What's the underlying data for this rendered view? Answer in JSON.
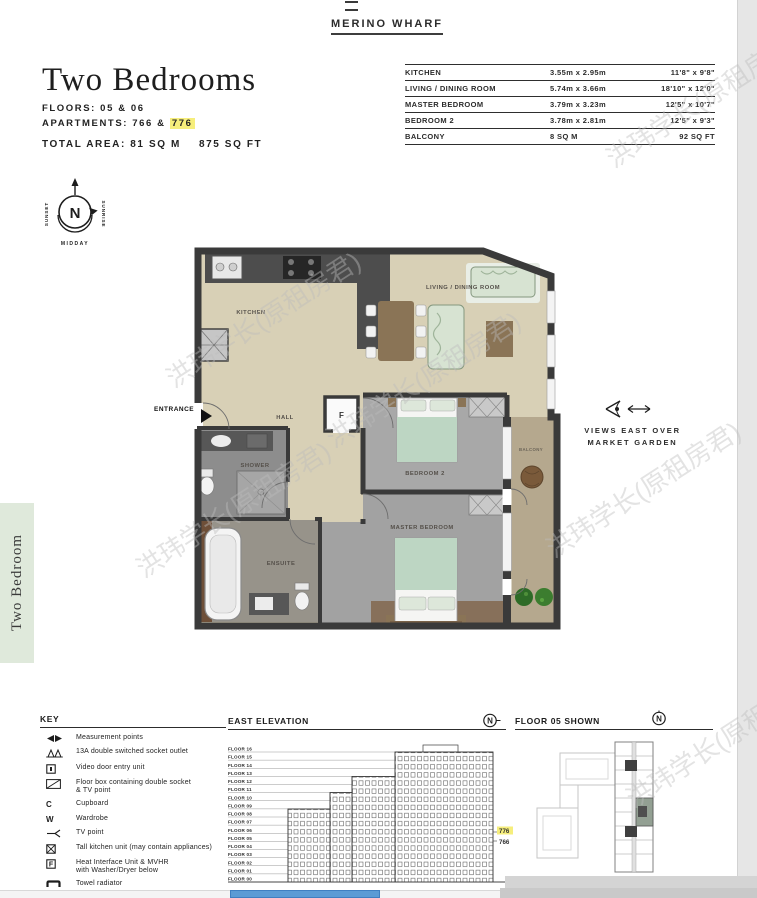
{
  "header": {
    "brand": "MERINO WHARF"
  },
  "title_block": {
    "title": "Two Bedrooms",
    "floors": "FLOORS: 05 & 06",
    "apartments_prefix": "APARTMENTS: 766 & ",
    "apartment_highlight": "776",
    "total_area_metric": "TOTAL AREA: 81 SQ M",
    "total_area_imperial": "875 SQ FT"
  },
  "dimensions_table": {
    "rows": [
      {
        "room": "KITCHEN",
        "metric": "3.55m x 2.95m",
        "imperial": "11'8\" x 9'8\""
      },
      {
        "room": "LIVING / DINING ROOM",
        "metric": "5.74m x 3.66m",
        "imperial": "18'10\" x 12'0\""
      },
      {
        "room": "MASTER BEDROOM",
        "metric": "3.79m x 3.23m",
        "imperial": "12'5\" x 10'7\""
      },
      {
        "room": "BEDROOM 2",
        "metric": "3.78m x 2.81m",
        "imperial": "12'5\" x 9'3\""
      },
      {
        "room": "BALCONY",
        "metric": "8 SQ M",
        "imperial": "92 SQ FT"
      }
    ]
  },
  "compass": {
    "north": "N",
    "west_label": "SUNSET",
    "east_label": "SUNRISE",
    "south_label": "MIDDAY"
  },
  "floorplan": {
    "labels": {
      "kitchen": "KITCHEN",
      "living": "LIVING / DINING ROOM",
      "hall": "HALL",
      "shower": "SHOWER",
      "ensuite": "ENSUITE",
      "bedroom2": "BEDROOM 2",
      "master": "MASTER BEDROOM",
      "balcony": "BALCONY",
      "entrance": "ENTRANCE",
      "f_unit": "F"
    }
  },
  "views_note": {
    "line1": "VIEWS EAST OVER",
    "line2": "MARKET GARDEN"
  },
  "side_tab": {
    "label": "Two Bedroom"
  },
  "key": {
    "title": "KEY",
    "items": [
      {
        "label": "Measurement points"
      },
      {
        "label": "13A double switched socket outlet"
      },
      {
        "label": "Video door entry unit"
      },
      {
        "label": "Floor box containing double socket",
        "label2": "& TV point"
      },
      {
        "symbol": "C",
        "label": "Cupboard"
      },
      {
        "symbol": "W",
        "label": "Wardrobe"
      },
      {
        "label": "TV point"
      },
      {
        "label": "Tall kitchen unit (may contain appliances)"
      },
      {
        "symbol": "F",
        "label": "Heat Interface Unit & MVHR",
        "label2": "with Washer/Dryer below"
      },
      {
        "label": "Towel radiator"
      },
      {
        "label": "Wi-Fi router and Sky box"
      }
    ]
  },
  "east_elevation": {
    "title": "EAST ELEVATION",
    "floors": [
      "FLOOR 16",
      "FLOOR 15",
      "FLOOR 14",
      "FLOOR 13",
      "FLOOR 12",
      "FLOOR 11",
      "FLOOR 10",
      "FLOOR 09",
      "FLOOR 08",
      "FLOOR 07",
      "FLOOR 06",
      "FLOOR 05",
      "FLOOR 04",
      "FLOOR 03",
      "FLOOR 02",
      "FLOOR 01",
      "FLOOR 00"
    ],
    "highlighted_unit": "776",
    "other_unit": "766"
  },
  "floor05_plan": {
    "title": "FLOOR 05 SHOWN"
  },
  "watermark": {
    "text": "洪玮学长(原租房君)"
  },
  "colors": {
    "highlight": "#f6ee7c",
    "tab_bg": "#dfe9db",
    "scrollbar_thumb": "#5b9bd5"
  }
}
